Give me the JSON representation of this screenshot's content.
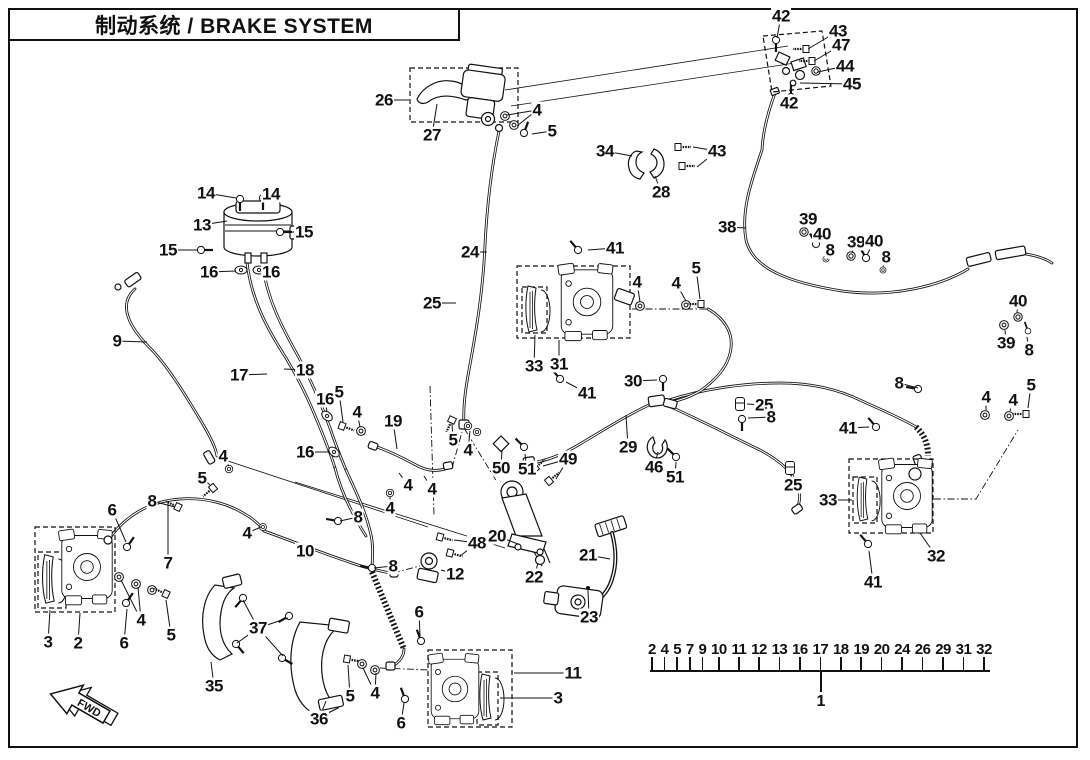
{
  "header": {
    "title": "制动系统 / BRAKE SYSTEM"
  },
  "direction_arrow_label": "FWD",
  "colors": {
    "ink": "#111111",
    "background": "#ffffff"
  },
  "index_strip": {
    "part_numbers": [
      "2",
      "4",
      "5",
      "7",
      "9",
      "10",
      "11",
      "12",
      "13",
      "16",
      "17",
      "18",
      "19",
      "20",
      "24",
      "26",
      "29",
      "31",
      "32"
    ],
    "assembly_number": "1"
  },
  "callouts": [
    {
      "t": "42",
      "x": 781,
      "y": 16,
      "to": [
        [
          777,
          38
        ]
      ]
    },
    {
      "t": "43",
      "x": 838,
      "y": 31,
      "to": [
        [
          808,
          49
        ]
      ]
    },
    {
      "t": "47",
      "x": 841,
      "y": 45,
      "to": [
        [
          814,
          61
        ]
      ]
    },
    {
      "t": "44",
      "x": 845,
      "y": 66,
      "to": [
        [
          818,
          72
        ]
      ]
    },
    {
      "t": "45",
      "x": 852,
      "y": 84,
      "to": [
        [
          800,
          83
        ]
      ]
    },
    {
      "t": "42",
      "x": 789,
      "y": 103,
      "to": [
        [
          790,
          96
        ]
      ]
    },
    {
      "t": "26",
      "x": 384,
      "y": 100,
      "to": [
        [
          409,
          100
        ]
      ]
    },
    {
      "t": "27",
      "x": 432,
      "y": 135,
      "to": [
        [
          437,
          104
        ]
      ]
    },
    {
      "t": "4",
      "x": 537,
      "y": 110,
      "to": [
        [
          507,
          115
        ],
        [
          517,
          126
        ]
      ]
    },
    {
      "t": "5",
      "x": 552,
      "y": 131,
      "to": [
        [
          532,
          134
        ]
      ]
    },
    {
      "t": "34",
      "x": 605,
      "y": 151,
      "to": [
        [
          632,
          156
        ]
      ]
    },
    {
      "t": "43",
      "x": 717,
      "y": 151,
      "to": [
        [
          693,
          147
        ],
        [
          697,
          167
        ]
      ]
    },
    {
      "t": "28",
      "x": 661,
      "y": 192,
      "to": [
        [
          655,
          176
        ]
      ]
    },
    {
      "t": "38",
      "x": 727,
      "y": 227,
      "to": [
        [
          746,
          228
        ]
      ]
    },
    {
      "t": "14",
      "x": 206,
      "y": 193,
      "to": [
        [
          236,
          198
        ]
      ]
    },
    {
      "t": "14",
      "x": 271,
      "y": 194,
      "to": [
        [
          264,
          198
        ]
      ]
    },
    {
      "t": "13",
      "x": 202,
      "y": 225,
      "to": [
        [
          227,
          221
        ]
      ]
    },
    {
      "t": "15",
      "x": 304,
      "y": 232,
      "to": [
        [
          283,
          232
        ]
      ]
    },
    {
      "t": "15",
      "x": 168,
      "y": 250,
      "to": [
        [
          198,
          250
        ]
      ]
    },
    {
      "t": "16",
      "x": 209,
      "y": 272,
      "to": [
        [
          236,
          271
        ]
      ]
    },
    {
      "t": "16",
      "x": 271,
      "y": 272,
      "to": [
        [
          262,
          271
        ]
      ]
    },
    {
      "t": "39",
      "x": 808,
      "y": 219,
      "to": [
        [
          805,
          229
        ]
      ]
    },
    {
      "t": "40",
      "x": 822,
      "y": 234,
      "to": [
        [
          817,
          242
        ]
      ]
    },
    {
      "t": "8",
      "x": 830,
      "y": 250,
      "to": [
        [
          827,
          257
        ]
      ]
    },
    {
      "t": "39",
      "x": 856,
      "y": 242,
      "to": [
        [
          852,
          253
        ]
      ]
    },
    {
      "t": "40",
      "x": 874,
      "y": 241,
      "to": [
        [
          867,
          255
        ]
      ]
    },
    {
      "t": "8",
      "x": 886,
      "y": 257,
      "to": [
        [
          883,
          267
        ]
      ]
    },
    {
      "t": "24",
      "x": 470,
      "y": 252,
      "to": [
        [
          487,
          252
        ]
      ]
    },
    {
      "t": "25",
      "x": 432,
      "y": 303,
      "to": [
        [
          456,
          303
        ]
      ]
    },
    {
      "t": "41",
      "x": 615,
      "y": 248,
      "to": [
        [
          588,
          250
        ]
      ]
    },
    {
      "t": "4",
      "x": 637,
      "y": 282,
      "to": [
        [
          640,
          302
        ]
      ]
    },
    {
      "t": "4",
      "x": 676,
      "y": 283,
      "to": [
        [
          686,
          301
        ]
      ]
    },
    {
      "t": "5",
      "x": 696,
      "y": 268,
      "to": [
        [
          700,
          299
        ]
      ]
    },
    {
      "t": "33",
      "x": 534,
      "y": 366,
      "to": [
        [
          535,
          335
        ]
      ]
    },
    {
      "t": "31",
      "x": 559,
      "y": 364,
      "to": [
        [
          559,
          340
        ]
      ]
    },
    {
      "t": "41",
      "x": 587,
      "y": 393,
      "to": [
        [
          566,
          382
        ]
      ]
    },
    {
      "t": "30",
      "x": 633,
      "y": 381,
      "to": [
        [
          657,
          380
        ]
      ]
    },
    {
      "t": "9",
      "x": 117,
      "y": 341,
      "to": [
        [
          147,
          342
        ]
      ]
    },
    {
      "t": "17",
      "x": 239,
      "y": 375,
      "to": [
        [
          267,
          374
        ]
      ]
    },
    {
      "t": "18",
      "x": 305,
      "y": 370,
      "to": [
        [
          284,
          369
        ]
      ]
    },
    {
      "t": "16",
      "x": 325,
      "y": 399,
      "to": [
        [
          327,
          412
        ]
      ]
    },
    {
      "t": "5",
      "x": 339,
      "y": 392,
      "to": [
        [
          343,
          422
        ]
      ]
    },
    {
      "t": "4",
      "x": 357,
      "y": 412,
      "to": [
        [
          360,
          427
        ]
      ]
    },
    {
      "t": "19",
      "x": 393,
      "y": 421,
      "to": [
        [
          397,
          449
        ]
      ]
    },
    {
      "t": "16",
      "x": 305,
      "y": 452,
      "to": [
        [
          330,
          452
        ]
      ]
    },
    {
      "t": "4",
      "x": 408,
      "y": 485,
      "to": [
        [
          399,
          473
        ]
      ]
    },
    {
      "t": "4",
      "x": 432,
      "y": 489,
      "to": [
        [
          424,
          476
        ]
      ]
    },
    {
      "t": "5",
      "x": 453,
      "y": 440,
      "to": [
        [
          452,
          424
        ]
      ]
    },
    {
      "t": "4",
      "x": 468,
      "y": 450,
      "to": [
        [
          470,
          431
        ]
      ]
    },
    {
      "t": "50",
      "x": 501,
      "y": 468,
      "to": [
        [
          502,
          450
        ]
      ]
    },
    {
      "t": "51",
      "x": 527,
      "y": 469,
      "to": [
        [
          525,
          454
        ]
      ]
    },
    {
      "t": "49",
      "x": 568,
      "y": 459,
      "to": [
        [
          543,
          466
        ],
        [
          556,
          479
        ]
      ]
    },
    {
      "t": "4",
      "x": 390,
      "y": 508,
      "to": [
        [
          390,
          497
        ]
      ]
    },
    {
      "t": "48",
      "x": 477,
      "y": 543,
      "to": [
        [
          454,
          540
        ],
        [
          460,
          556
        ]
      ]
    },
    {
      "t": "20",
      "x": 497,
      "y": 536,
      "to": [
        [
          518,
          544
        ]
      ]
    },
    {
      "t": "12",
      "x": 455,
      "y": 574,
      "to": [
        [
          441,
          570
        ]
      ]
    },
    {
      "t": "22",
      "x": 534,
      "y": 577,
      "to": [
        [
          538,
          563
        ]
      ]
    },
    {
      "t": "21",
      "x": 588,
      "y": 555,
      "to": [
        [
          610,
          559
        ]
      ]
    },
    {
      "t": "23",
      "x": 589,
      "y": 617,
      "to": [
        [
          588,
          590
        ]
      ]
    },
    {
      "t": "4",
      "x": 223,
      "y": 456,
      "to": [
        [
          229,
          466
        ]
      ]
    },
    {
      "t": "5",
      "x": 202,
      "y": 478,
      "to": [
        [
          210,
          485
        ]
      ]
    },
    {
      "t": "8",
      "x": 152,
      "y": 501,
      "to": [
        [
          175,
          507
        ]
      ]
    },
    {
      "t": "6",
      "x": 112,
      "y": 510,
      "to": [
        [
          126,
          542
        ]
      ]
    },
    {
      "t": "4",
      "x": 247,
      "y": 533,
      "to": [
        [
          261,
          527
        ]
      ]
    },
    {
      "t": "10",
      "x": 305,
      "y": 551,
      "to": [
        [
          313,
          559
        ]
      ]
    },
    {
      "t": "8",
      "x": 358,
      "y": 517,
      "to": [
        [
          340,
          521
        ]
      ]
    },
    {
      "t": "8",
      "x": 393,
      "y": 566,
      "to": [
        [
          374,
          568
        ]
      ]
    },
    {
      "t": "7",
      "x": 168,
      "y": 563,
      "to": [
        [
          168,
          502
        ]
      ]
    },
    {
      "t": "3",
      "x": 48,
      "y": 642,
      "to": [
        [
          50,
          610
        ]
      ]
    },
    {
      "t": "2",
      "x": 78,
      "y": 643,
      "to": [
        [
          80,
          613
        ]
      ]
    },
    {
      "t": "6",
      "x": 124,
      "y": 643,
      "to": [
        [
          127,
          609
        ]
      ]
    },
    {
      "t": "4",
      "x": 141,
      "y": 620,
      "to": [
        [
          121,
          580
        ],
        [
          138,
          587
        ]
      ]
    },
    {
      "t": "5",
      "x": 171,
      "y": 635,
      "to": [
        [
          166,
          600
        ]
      ]
    },
    {
      "t": "37",
      "x": 258,
      "y": 628,
      "to": [
        [
          243,
          600
        ],
        [
          237,
          643
        ],
        [
          288,
          618
        ],
        [
          283,
          656
        ]
      ]
    },
    {
      "t": "35",
      "x": 214,
      "y": 686,
      "to": [
        [
          211,
          662
        ]
      ]
    },
    {
      "t": "36",
      "x": 319,
      "y": 719,
      "to": [
        [
          326,
          701
        ]
      ]
    },
    {
      "t": "5",
      "x": 350,
      "y": 696,
      "to": [
        [
          348,
          665
        ]
      ]
    },
    {
      "t": "4",
      "x": 375,
      "y": 693,
      "to": [
        [
          363,
          668
        ],
        [
          376,
          673
        ]
      ]
    },
    {
      "t": "6",
      "x": 401,
      "y": 723,
      "to": [
        [
          404,
          703
        ]
      ]
    },
    {
      "t": "6",
      "x": 419,
      "y": 612,
      "to": [
        [
          420,
          636
        ]
      ]
    },
    {
      "t": "11",
      "x": 573,
      "y": 673,
      "to": [
        [
          514,
          673
        ]
      ]
    },
    {
      "t": "3",
      "x": 558,
      "y": 698,
      "to": [
        [
          500,
          698
        ]
      ]
    },
    {
      "t": "29",
      "x": 628,
      "y": 447,
      "to": [
        [
          626,
          415
        ]
      ]
    },
    {
      "t": "46",
      "x": 654,
      "y": 467,
      "to": [
        [
          658,
          452
        ]
      ]
    },
    {
      "t": "51",
      "x": 675,
      "y": 477,
      "to": [
        [
          676,
          462
        ]
      ]
    },
    {
      "t": "25",
      "x": 764,
      "y": 405,
      "to": [
        [
          747,
          404
        ]
      ]
    },
    {
      "t": "8",
      "x": 771,
      "y": 417,
      "to": [
        [
          748,
          418
        ]
      ]
    },
    {
      "t": "25",
      "x": 793,
      "y": 485,
      "to": [
        [
          791,
          474
        ]
      ]
    },
    {
      "t": "8",
      "x": 899,
      "y": 383,
      "to": [
        [
          918,
          388
        ]
      ]
    },
    {
      "t": "33",
      "x": 828,
      "y": 500,
      "to": [
        [
          852,
          500
        ]
      ]
    },
    {
      "t": "32",
      "x": 936,
      "y": 556,
      "to": [
        [
          920,
          533
        ]
      ]
    },
    {
      "t": "41",
      "x": 848,
      "y": 428,
      "to": [
        [
          869,
          427
        ]
      ]
    },
    {
      "t": "41",
      "x": 873,
      "y": 582,
      "to": [
        [
          869,
          551
        ]
      ]
    },
    {
      "t": "4",
      "x": 986,
      "y": 397,
      "to": [
        [
          986,
          410
        ]
      ]
    },
    {
      "t": "4",
      "x": 1013,
      "y": 400,
      "to": [
        [
          1010,
          411
        ]
      ]
    },
    {
      "t": "5",
      "x": 1031,
      "y": 385,
      "to": [
        [
          1028,
          408
        ]
      ]
    },
    {
      "t": "40",
      "x": 1018,
      "y": 301,
      "to": [
        [
          1017,
          313
        ]
      ]
    },
    {
      "t": "39",
      "x": 1006,
      "y": 343,
      "to": [
        [
          1005,
          330
        ]
      ]
    },
    {
      "t": "8",
      "x": 1029,
      "y": 350,
      "to": [
        [
          1027,
          337
        ]
      ]
    }
  ]
}
